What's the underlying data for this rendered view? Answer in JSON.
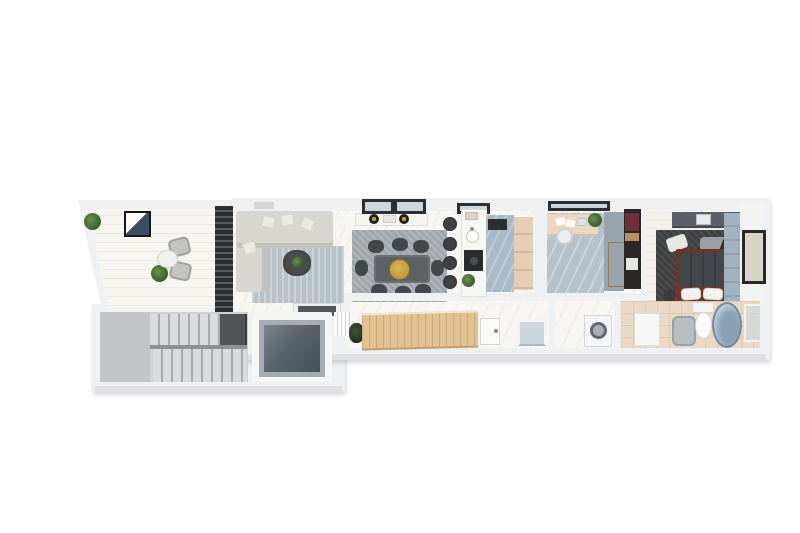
{
  "scene": {
    "type": "3d-floor-plan-render",
    "description": "Top-down 3D architectural render of a long, narrow apartment with terrace, living room, dining area, galley kitchen, home office, closet, bedroom, balcony, hallway, laundry, bathroom, staircase and elevator",
    "background": "#ffffff"
  },
  "palette": {
    "wall": "#eef0f1",
    "wall-shade": "#d4d6d8",
    "floor-light": "#f8f6f2",
    "floor-terrace": "#f7f5f0",
    "floor-blue": "#a9bac7",
    "floor-office": "#b4c2cd",
    "floor-bath": "#ead9c4",
    "beige": "#e5cfb4",
    "wood": "#e2c193",
    "shelf-wood": "#c99f6b",
    "dark-frame": "#2c2f31",
    "glass": "#ccd6dc",
    "sofa": "#d8d6d1",
    "sofa-edge": "#c3c1bc",
    "rug-living": "#b7c1c8",
    "rug-dining": "#9fa5a8",
    "rug-bed": "#3e4042",
    "chair-dark": "#44474a",
    "chair-gray": "#c2c4c0",
    "gold": "#c09a3e",
    "green": "#69924c",
    "green-dark": "#39572e",
    "grill-blue": "#3d4c63",
    "bed-frame": "#6f3528",
    "bed-blanket": "#43474b",
    "accent-wall": "#a3b2c0",
    "closet-bg": "#2b2725",
    "maroon": "#6e3037",
    "tub": "#8aa0b5"
  },
  "rooms": [
    {
      "name": "terrace",
      "furniture": [
        "bbq-grill",
        "potted-plant",
        "potted-plant",
        "outdoor-chair",
        "outdoor-chair",
        "side-table",
        "slat-partition"
      ]
    },
    {
      "name": "living-room",
      "furniture": [
        "sectional-sofa",
        "throw-cushions",
        "area-rug",
        "coffee-table-with-plant",
        "tv-console",
        "tv"
      ]
    },
    {
      "name": "dining-area",
      "furniture": [
        "dining-table",
        "eight-chairs",
        "area-rug",
        "gold-pendant-lamp",
        "wall-counter-with-cooktop",
        "skylight-window"
      ]
    },
    {
      "name": "kitchen",
      "furniture": [
        "breakfast-bar",
        "four-bar-stools",
        "sink",
        "cooktop",
        "tall-beige-cabinets",
        "dark-appliance"
      ]
    },
    {
      "name": "home-office",
      "furniture": [
        "desk",
        "papers",
        "laptop",
        "desk-plant",
        "office-chair",
        "wood-shelf-unit"
      ]
    },
    {
      "name": "closet",
      "furniture": [
        "open-shelving-with-clothes",
        "storage-box"
      ]
    },
    {
      "name": "bedroom",
      "furniture": [
        "double-bed",
        "pillows",
        "dark-area-rug",
        "wardrobe",
        "bench",
        "nightstands",
        "gold-table-lamp",
        "paneled-accent-wall"
      ]
    },
    {
      "name": "balcony",
      "furniture": [
        "dark-framed-glazing"
      ]
    },
    {
      "name": "hallway",
      "furniture": [
        "slatted-wood-wardrobe",
        "entry-door",
        "coat-plant",
        "stair-railing",
        "storage-bench"
      ]
    },
    {
      "name": "laundry",
      "furniture": [
        "washing-machine"
      ]
    },
    {
      "name": "bathroom",
      "furniture": [
        "vanity",
        "shower-basin",
        "toilet",
        "oval-bathtub",
        "glass-shower-screen"
      ]
    },
    {
      "name": "staircase",
      "furniture": [
        "upper-flight",
        "dark-landing",
        "lower-flight",
        "side-landing"
      ]
    },
    {
      "name": "elevator",
      "furniture": [
        "glass-cabin"
      ]
    }
  ]
}
